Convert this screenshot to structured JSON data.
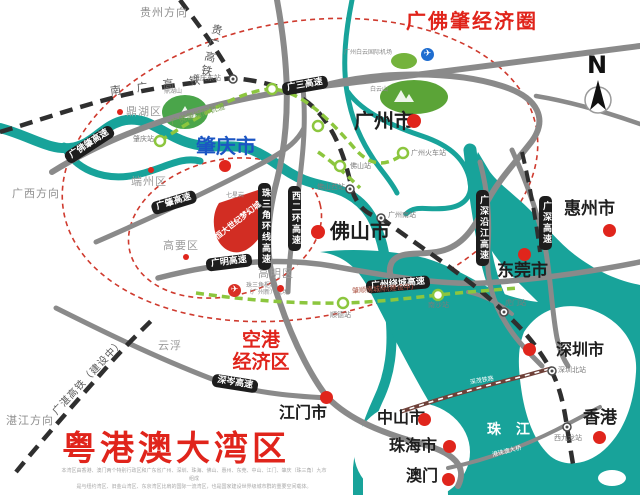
{
  "regions": {
    "economic_circle": "广佛肇经济圈",
    "bay_area": "粤港澳大湾区",
    "airport_zone_line1": "空港",
    "airport_zone_line2": "经济区"
  },
  "compass": {
    "north": "N"
  },
  "cities": {
    "zhaoqing": "肇庆市",
    "guangzhou": "广州市",
    "foshan": "佛山市",
    "huizhou": "惠州市",
    "dongguan": "东莞市",
    "shenzhen": "深圳市",
    "hongkong": "香港",
    "macau": "澳门",
    "zhuhai": "珠海市",
    "zhongshan": "中山市",
    "jiangmen": "江门市"
  },
  "districts": {
    "dinghu": "鼎湖区",
    "duanzhou": "端州区",
    "gaoyao": "高要区",
    "gaoming": "高明区",
    "yunfu": "云浮"
  },
  "directions": {
    "guizhou": "贵州方向",
    "guangxi": "广西方向",
    "zhanjiang": "湛江方向"
  },
  "roads": {
    "gfz": "广佛肇高速",
    "gs": "广三高速",
    "gz": "广肇高速",
    "zsjhx": "珠三角环线高速",
    "xeh": "西二环高速",
    "gm": "广明高速",
    "gzrc": "广州绕城高速",
    "gsyj": "广深沿江高速",
    "gshen": "广深高速",
    "sc": "深岑高速",
    "hzmb": "港珠澳大桥"
  },
  "railways": {
    "guiguang": "贵广高铁",
    "nanguang": "南 广 高 铁",
    "guangzhan": "广湛高铁（建设中）",
    "shenmao": "深茂铁路",
    "gfzicr": "广佛肇城际轨道",
    "zsn": "肇顺南城际(建设中)"
  },
  "stations": {
    "zhaoqing_east": "肇庆东站",
    "zhaoqing": "肇庆站",
    "foshan_west": "佛山西站",
    "foshan": "佛山站",
    "guangzhou_main": "广州火车站",
    "guangzhou_south": "广州南站",
    "shunde": "顺德站",
    "nansha": "南沙站",
    "humen": "虎门站",
    "shenzhen_north": "深圳北站",
    "west_kowloon": "西九龙站"
  },
  "landmarks": {
    "baiyun_airport": "广州白云国际机场",
    "prd_airport_line1": "珠三角枢纽",
    "prd_airport_line2": "（广州新）机场",
    "evergrande": "恒大世纪梦幻城",
    "dinghushan": "鼎湖山",
    "qixingyan": "七星岩",
    "baiyunshan": "白云山",
    "pearl_river": "珠 江",
    "plane_icon": "✈"
  },
  "fine_print": {
    "line1": "本湾区由香港、澳门两个特别行政区和广东省广州、深圳、珠海、佛山、惠州、东莞、中山、江门、肇庆（珠三角）九市组成",
    "line2": "是与纽约湾区、旧金山湾区、东京湾区比肩的国际一流湾区，也是国家建设世界级城市群的重要空间载体。"
  }
}
